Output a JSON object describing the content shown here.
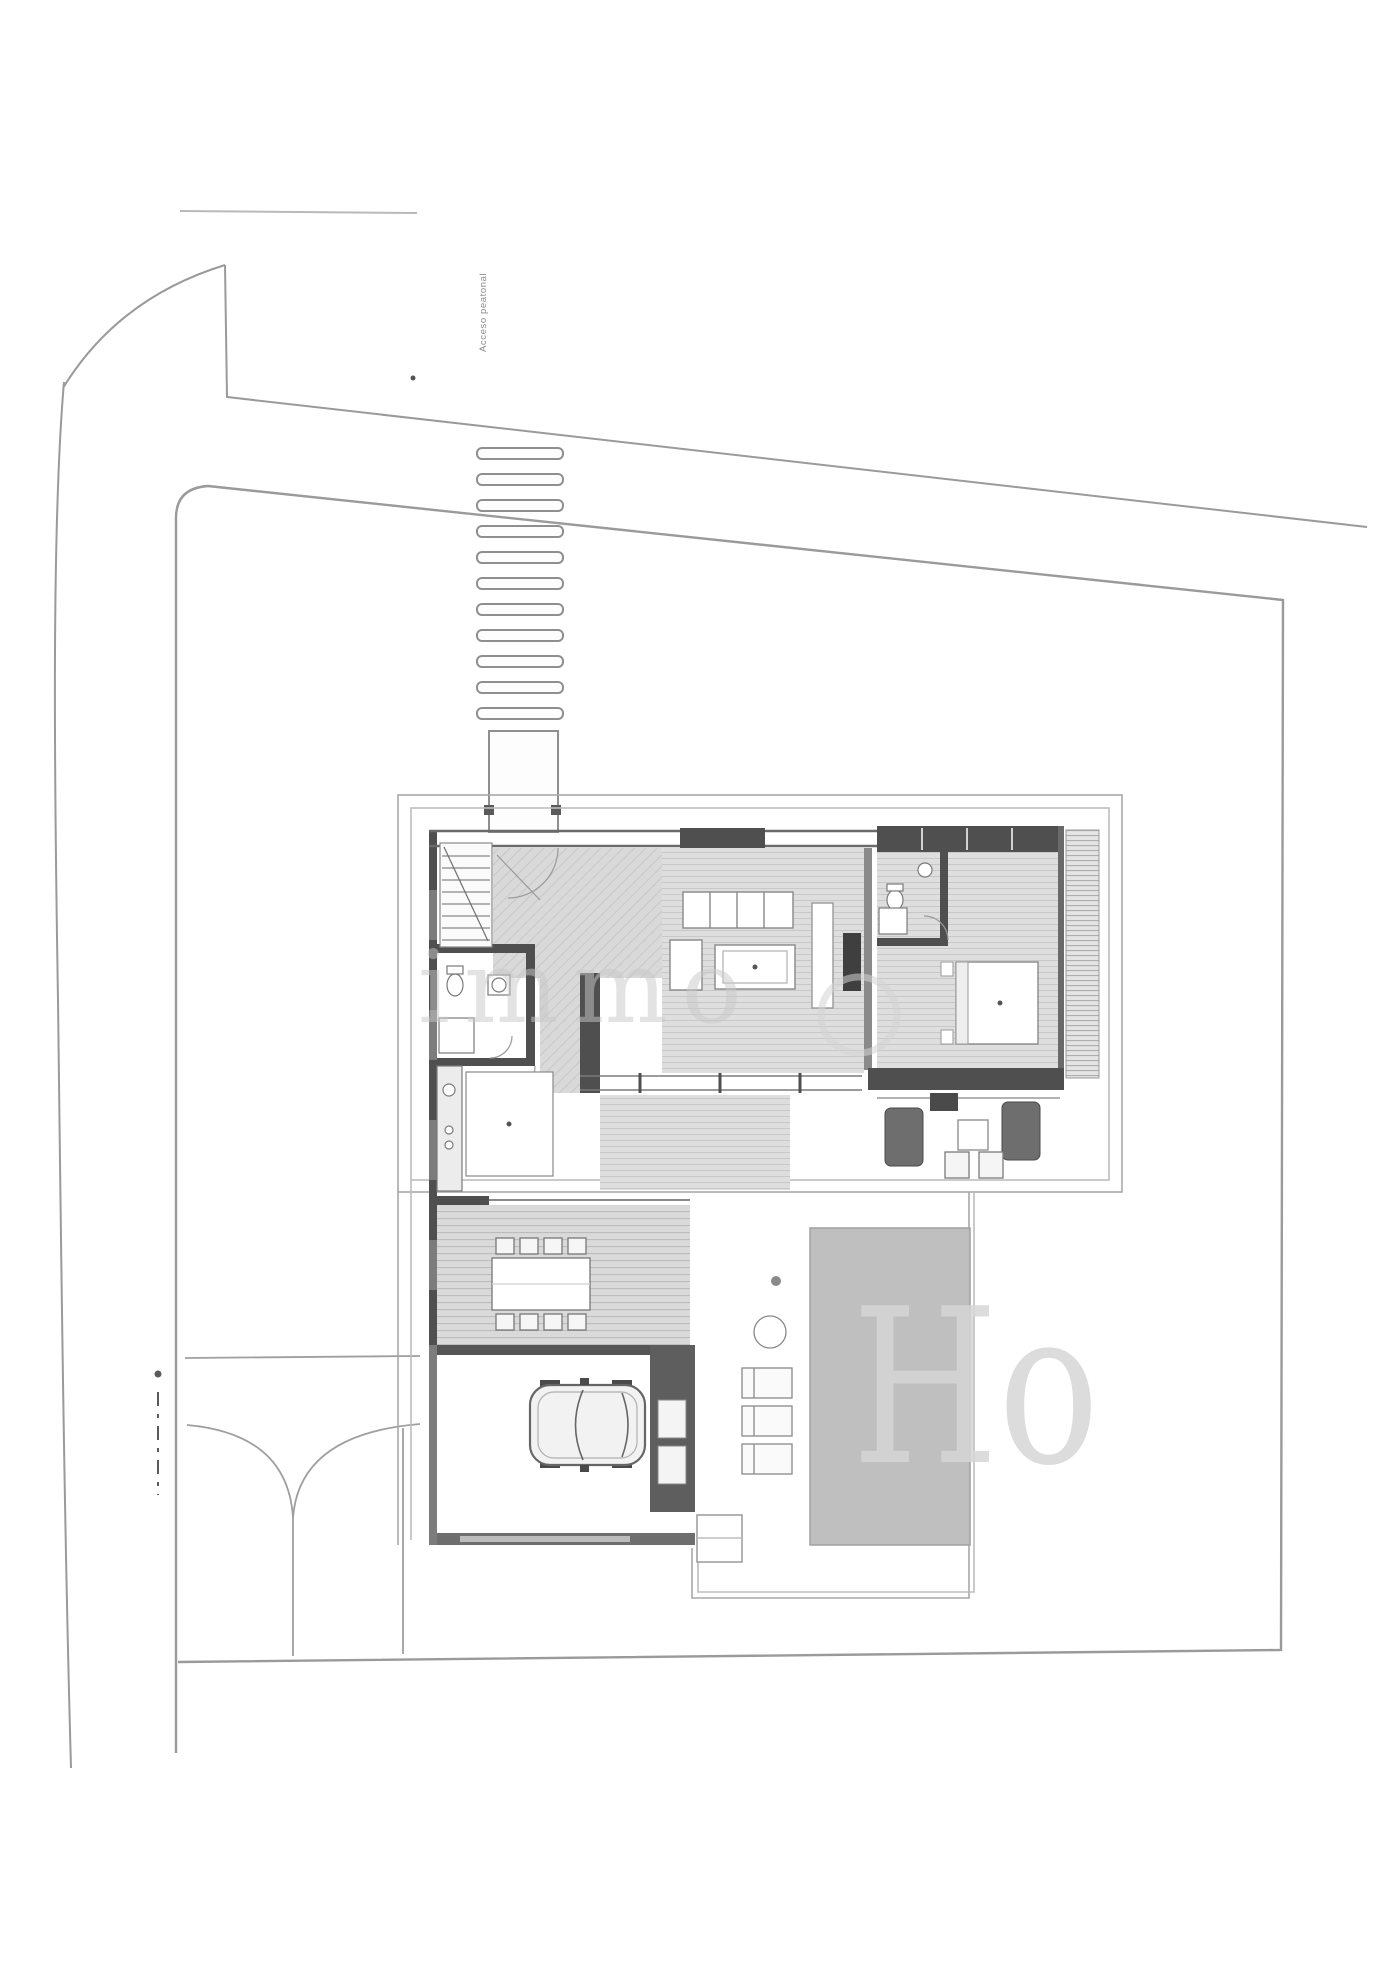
{
  "page": {
    "background": "#ffffff",
    "drawing_type_note": "site plan with villa floor plan, pool and garage"
  },
  "labels": {
    "path_label": "Acceso peatonal"
  },
  "watermark": {
    "mid": "immo",
    "large": "Ho"
  },
  "colors": {
    "boundary_line": "#9a9a9a",
    "platform_line": "#a8a8a8",
    "wall_dark": "#4f4f4f",
    "wall_medium": "#7c7c7c",
    "floor_fill": "#dcdcdc",
    "hatch_line": "#c4c4c4",
    "pool_fill": "#bfbfbf",
    "car_fill": "#f2f2f2",
    "watermark_gray": "#d2d2d2"
  }
}
